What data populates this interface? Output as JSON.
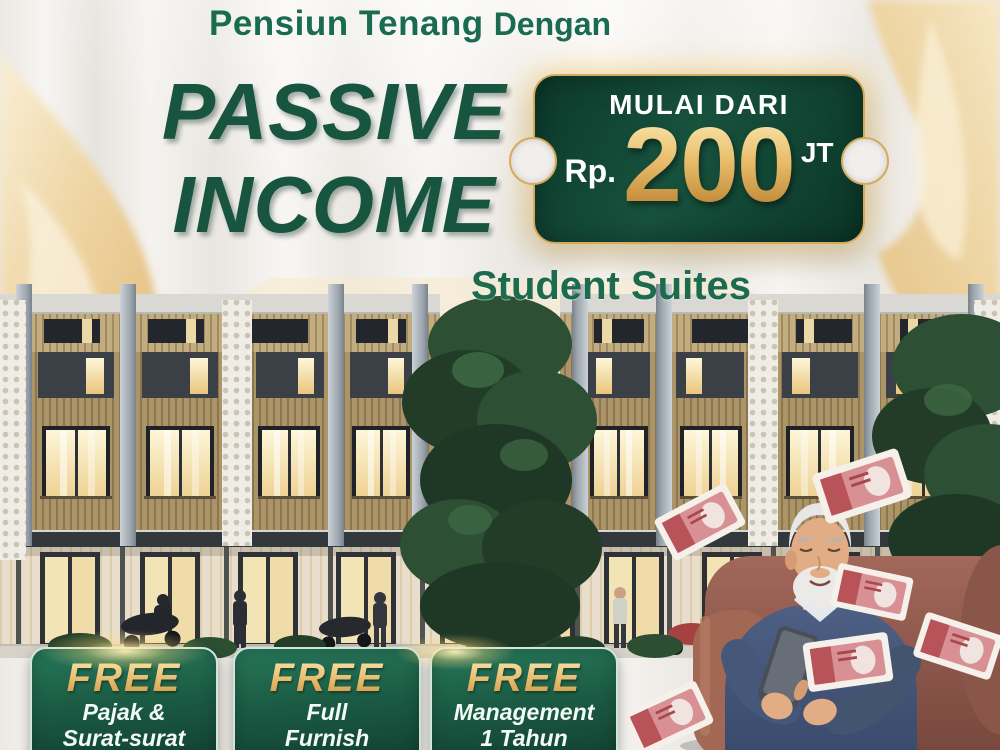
{
  "header": {
    "title_strong": "Pensiun Tenang",
    "title_rest": "Dengan"
  },
  "headline": {
    "line1": "PASSIVE",
    "line2": "INCOME"
  },
  "price_ticket": {
    "label": "MULAI DARI",
    "currency": "Rp.",
    "amount": "200",
    "unit": "JT"
  },
  "subtitle": "Student Suites",
  "free_badges": [
    {
      "title": "FREE",
      "line1": "Pajak &",
      "line2": "Surat-surat"
    },
    {
      "title": "FREE",
      "line1": "Full",
      "line2": "Furnish"
    },
    {
      "title": "FREE",
      "line1": "Management",
      "line2": "1 Tahun"
    }
  ],
  "colors": {
    "brand_green": "#175540",
    "accent_green": "#1B6B4E",
    "ticket_green_dark": "#0C3A2B",
    "badge_green": "#1D6B4E",
    "gold": "#D9A84E",
    "fabric_gold": "#EED9A8",
    "curtain_white": "#F2F0EC",
    "chair_maroon": "#8A5648",
    "sweater_blue": "#44587A",
    "banknote_red": "#C25A5E",
    "window_glow": "#F2E3B6"
  },
  "scene_icons": {
    "gold_drapes": "gold-fabric-drape",
    "building": "building-illustration",
    "center_tree": "tree-illustration",
    "right_tree": "tree-illustration",
    "retiree": "retiree-with-phone",
    "armchair": "armchair",
    "banknotes": "flying-banknotes",
    "glow": "gold-glow"
  }
}
